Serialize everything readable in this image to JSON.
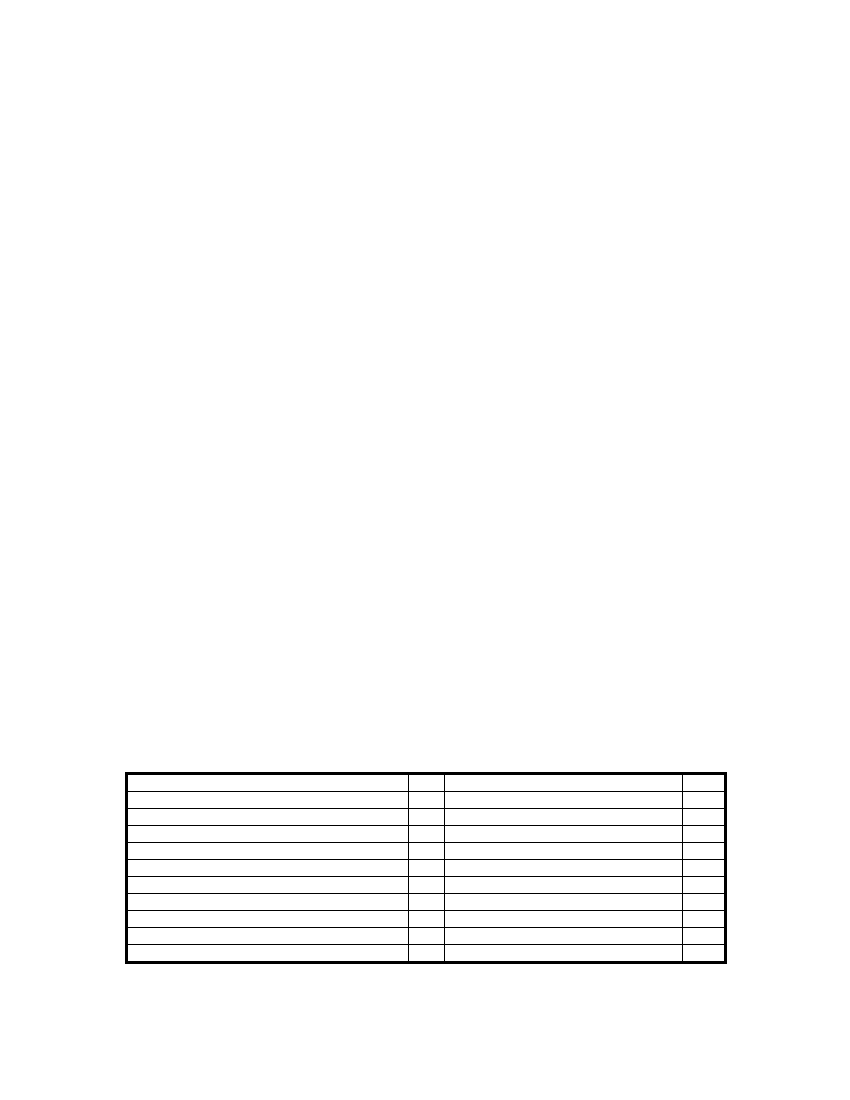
{
  "page": {
    "background_color": "#ffffff"
  },
  "table": {
    "kind": "empty-ruled-form-table",
    "border_color": "#000000",
    "row_count": 11,
    "column_count": 4,
    "rows": [
      [
        "",
        "",
        "",
        ""
      ],
      [
        "",
        "",
        "",
        ""
      ],
      [
        "",
        "",
        "",
        ""
      ],
      [
        "",
        "",
        "",
        ""
      ],
      [
        "",
        "",
        "",
        ""
      ],
      [
        "",
        "",
        "",
        ""
      ],
      [
        "",
        "",
        "",
        ""
      ],
      [
        "",
        "",
        "",
        ""
      ],
      [
        "",
        "",
        "",
        ""
      ],
      [
        "",
        "",
        "",
        ""
      ],
      [
        "",
        "",
        "",
        ""
      ]
    ]
  }
}
